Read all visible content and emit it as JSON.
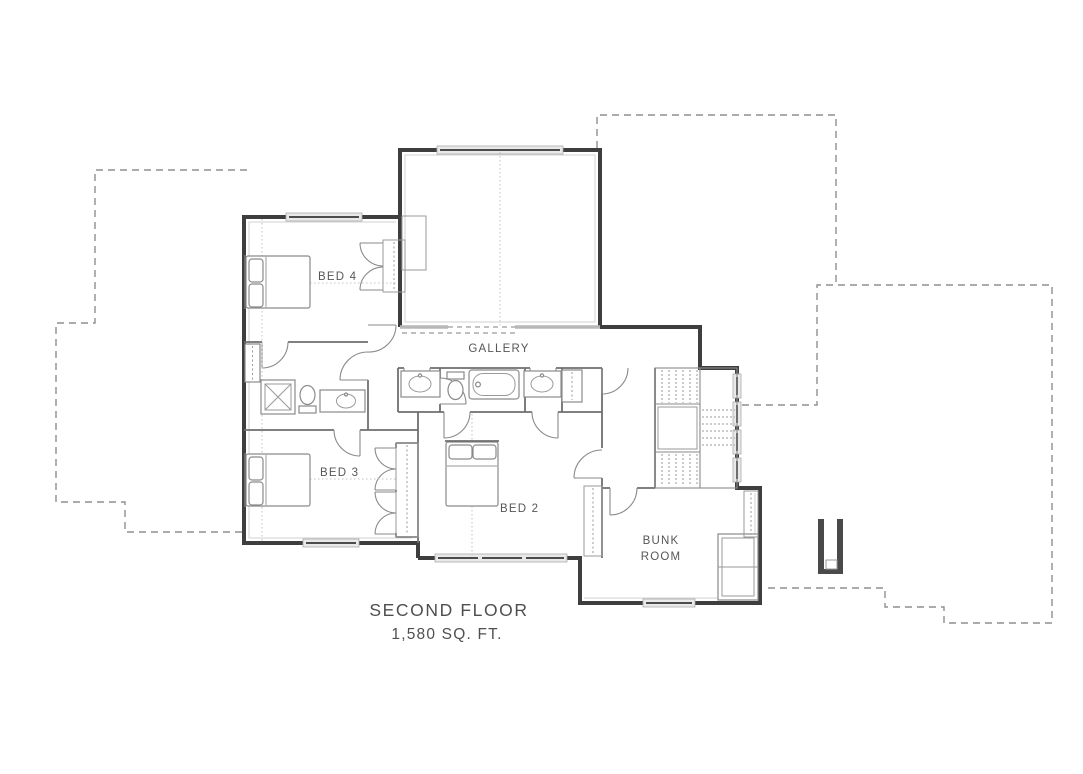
{
  "plan": {
    "title": "SECOND FLOOR",
    "subtitle": "1,580 SQ. FT.",
    "rooms": [
      {
        "id": "bed4",
        "label": "BED 4"
      },
      {
        "id": "bed3",
        "label": "BED 3"
      },
      {
        "id": "bed2",
        "label": "BED 2"
      },
      {
        "id": "gallery",
        "label": "GALLERY"
      },
      {
        "id": "bunk-room",
        "label_line1": "BUNK",
        "label_line2": "ROOM"
      }
    ],
    "colors": {
      "exterior_wall": "#3e3e3e",
      "interior_wall": "#6f6f6f",
      "fixture_line": "#8a8a8a",
      "roof_dashed_line": "#8f8f8f",
      "window_glass": "#e9e9e9",
      "label_text": "#565656",
      "background": "#ffffff"
    }
  }
}
